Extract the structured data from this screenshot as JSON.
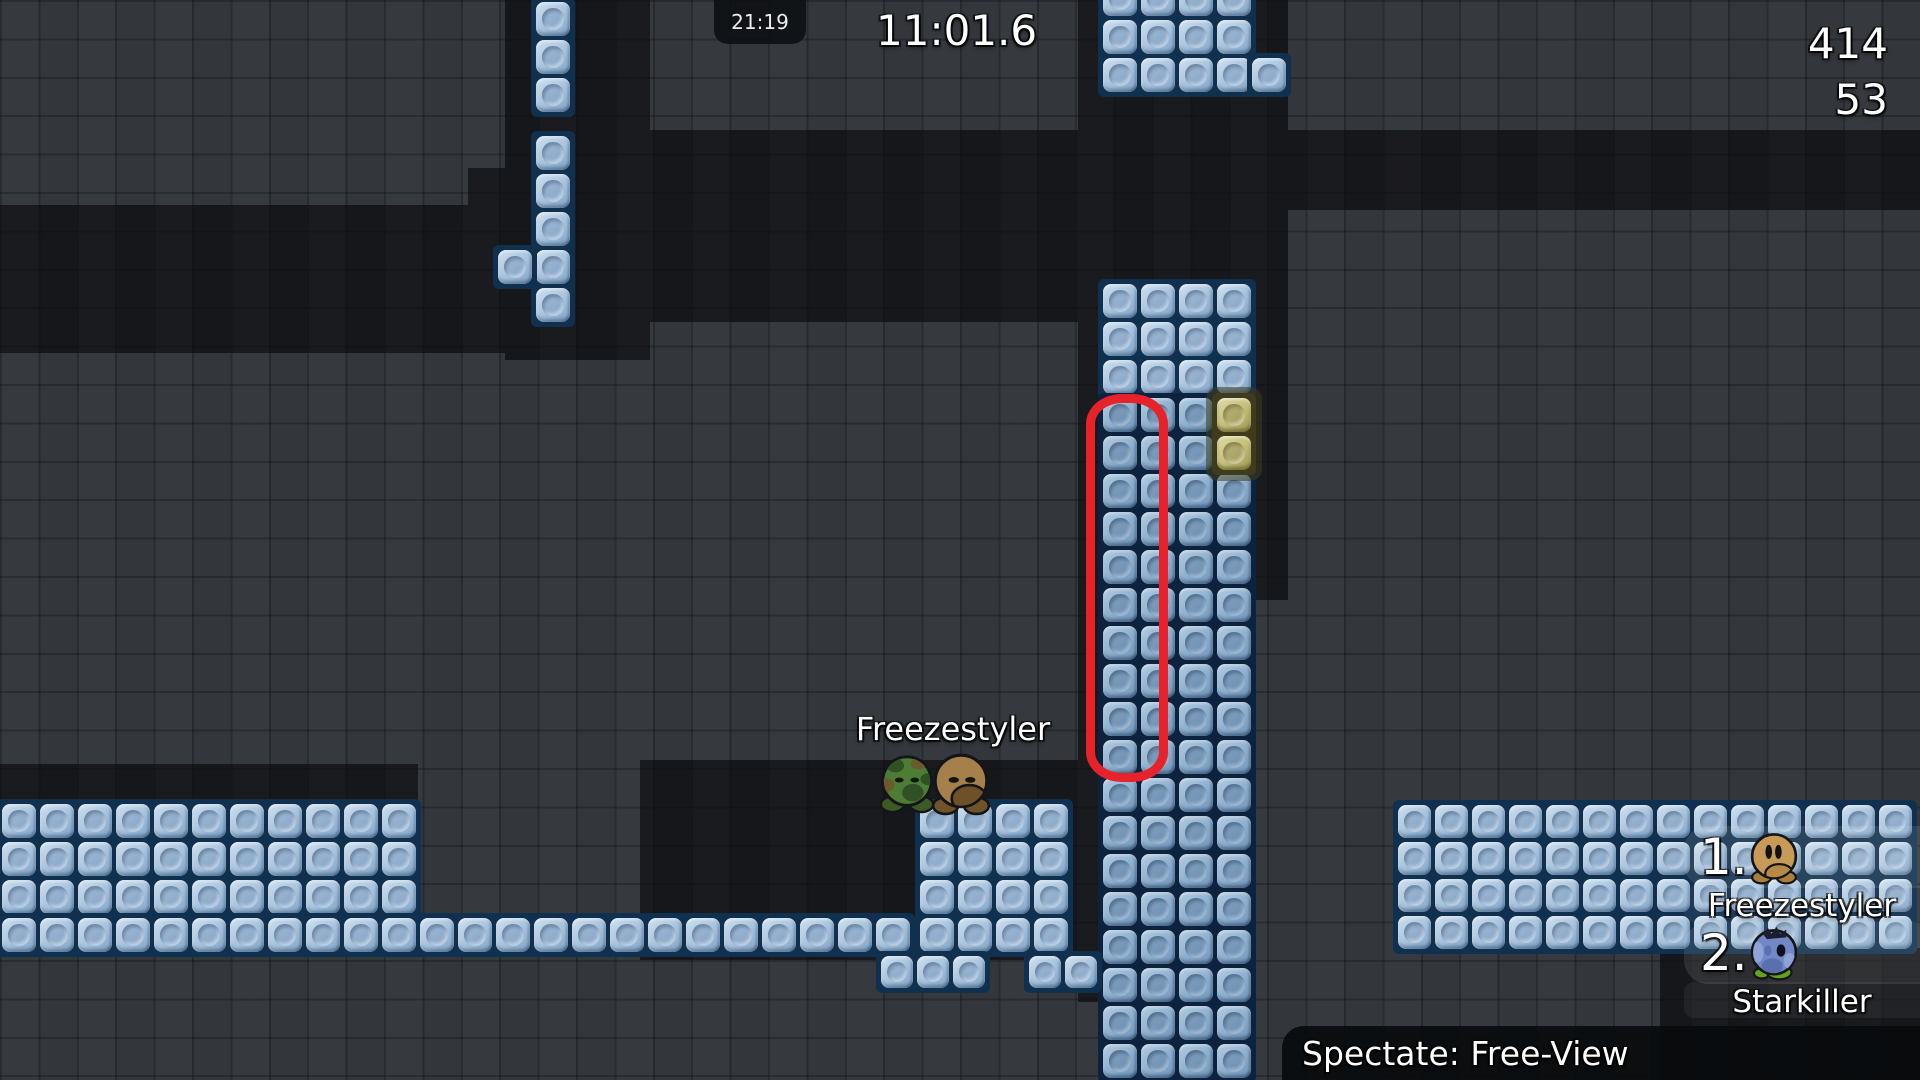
{
  "hud": {
    "clock": "21:19",
    "race_timer": "11:01.6",
    "top_right": {
      "line1": "414",
      "line2": "53"
    },
    "spectate": {
      "label": "Spectate: Free-View"
    }
  },
  "world": {
    "name_label": {
      "text": "Freezestyler"
    },
    "players": [
      {
        "skin": "green-camo",
        "x": 876,
        "y": 752,
        "size": 62
      },
      {
        "skin": "brown",
        "x": 928,
        "y": 750,
        "size": 66
      }
    ]
  },
  "leaderboard": {
    "entries": [
      {
        "rank": "1.",
        "name": "Freezestyler",
        "skin": "tan"
      },
      {
        "rank": "2.",
        "name": "Starkiller",
        "skin": "blue-koala"
      }
    ]
  },
  "skins": {
    "green-camo": {
      "body": "#4d7c35",
      "feet": "#3b5a26",
      "outline": "#141517",
      "spot1": "#2f5124",
      "spot2": "#6b5b2c",
      "eye": "#10180e"
    },
    "brown": {
      "body": "#a5804b",
      "feet": "#6f5329",
      "outline": "#141517",
      "muzzle": "#6e5128",
      "eye": "#141517"
    },
    "tan": {
      "body": "#c89a58",
      "feet": "#a97e3b",
      "outline": "#141517",
      "muzzle": "#b68a45",
      "eye": "#121212"
    },
    "blue-koala": {
      "body": "#7288c6",
      "feet": "#5fa321",
      "outline": "#141517",
      "stripe_light": "#8fa3d6",
      "stripe_dark": "#5a6fae",
      "hair": "#1b1e2e",
      "eye": "#10101c"
    }
  },
  "map": {
    "colors": {
      "background": "#33363b",
      "tunnel": "#16171a",
      "block_light_hi": "#cfe1f0",
      "block_light_mid": "#a6c3de",
      "block_light_lo": "#7fa2c4",
      "block_light_backing": "#10304f",
      "block_mid_hi": "#b3cde3",
      "block_mid_mid": "#8db0d0",
      "block_mid_lo": "#6f93b8",
      "block_mid_backing": "#0c2340",
      "block_yellow_hi": "#e0dba6",
      "block_yellow_mid": "#c5bf78",
      "block_yellow_lo": "#9d964e",
      "block_yellow_backing": "#3e3c1d",
      "annotation": "#e8222a",
      "panel_bg": "rgba(9,11,13,0.93)"
    },
    "tunnels": [
      [
        505,
        0,
        145,
        360
      ],
      [
        0,
        205,
        650,
        148
      ],
      [
        468,
        168,
        182,
        40
      ],
      [
        640,
        130,
        442,
        192
      ],
      [
        1078,
        0,
        210,
        285
      ],
      [
        1078,
        280,
        23,
        722
      ],
      [
        1248,
        93,
        40,
        507
      ],
      [
        1288,
        130,
        632,
        80
      ],
      [
        0,
        764,
        418,
        38
      ],
      [
        640,
        760,
        442,
        200
      ],
      [
        1660,
        948,
        260,
        132
      ]
    ],
    "block_groups": [
      {
        "x": 534,
        "y": 0,
        "cols": 1,
        "rows": 3,
        "unit": 38,
        "style": "light"
      },
      {
        "x": 534,
        "y": 134,
        "cols": 1,
        "rows": 5,
        "unit": 38,
        "style": "light"
      },
      {
        "x": 496,
        "y": 248,
        "cols": 1,
        "rows": 1,
        "unit": 38,
        "style": "light"
      },
      {
        "x": 1101,
        "y": -20,
        "cols": 4,
        "rows": 3,
        "unit": 38,
        "style": "light"
      },
      {
        "x": 1250,
        "y": 56,
        "cols": 1,
        "rows": 1,
        "unit": 38,
        "style": "light"
      },
      {
        "x": 1101,
        "y": 282,
        "cols": 4,
        "rows": 3,
        "unit": 38,
        "style": "light"
      },
      {
        "x": 1101,
        "y": 396,
        "cols": 4,
        "rows": 18,
        "unit": 38,
        "style": "mid"
      },
      {
        "x": 1215,
        "y": 396,
        "cols": 1,
        "rows": 2,
        "unit": 38,
        "style": "yellow"
      },
      {
        "x": 0,
        "y": 802,
        "cols": 11,
        "rows": 3,
        "unit": 38,
        "style": "light"
      },
      {
        "x": 0,
        "y": 916,
        "cols": 24,
        "rows": 1,
        "unit": 38,
        "style": "light"
      },
      {
        "x": 918,
        "y": 802,
        "cols": 4,
        "rows": 4,
        "unit": 38,
        "style": "light"
      },
      {
        "x": 879,
        "y": 954,
        "cols": 3,
        "rows": 1,
        "unit": 36,
        "style": "light"
      },
      {
        "x": 1027,
        "y": 954,
        "cols": 2,
        "rows": 1,
        "unit": 36,
        "style": "light"
      },
      {
        "x": 1396,
        "y": 803,
        "cols": 14,
        "rows": 4,
        "unit": 37,
        "style": "light"
      }
    ],
    "annotation": {
      "shape": "rounded-ellipse",
      "x": 1086,
      "y": 394,
      "width": 64,
      "height": 370,
      "stroke": 9
    }
  }
}
